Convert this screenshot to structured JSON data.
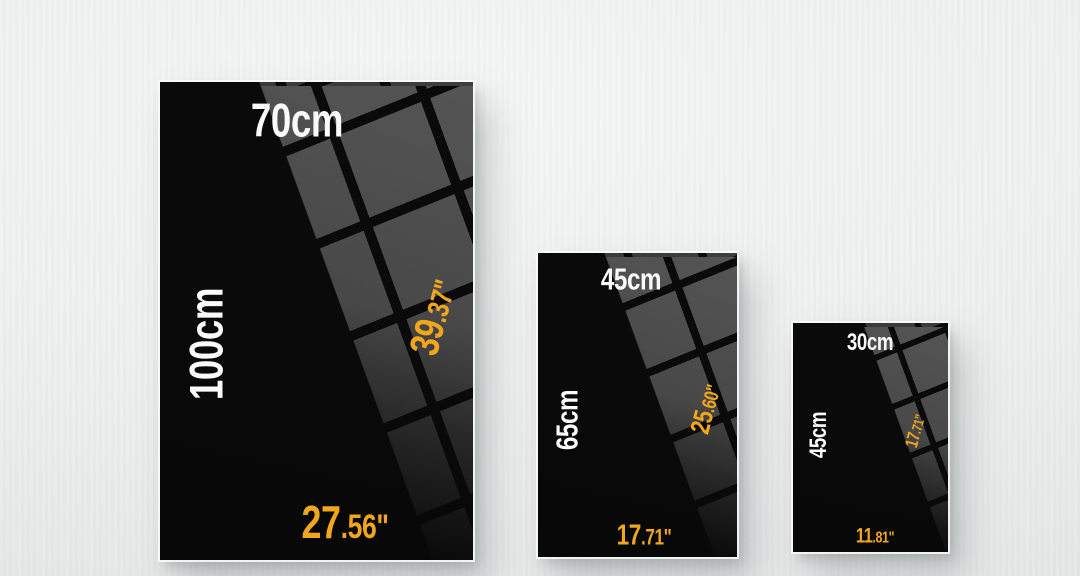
{
  "colors": {
    "accent_orange": "#F2A61D",
    "label_white": "#FAFAFA",
    "poster_black": "#0A0A0A",
    "pattern_gray": "#484848",
    "wall_light": "#F1F2F2"
  },
  "posters": [
    {
      "id": "large",
      "width_cm": "70cm",
      "height_cm": "100cm",
      "height_in_main": "39",
      "height_in_frac": ".37\"",
      "width_in_main": "27",
      "width_in_frac": ".56\""
    },
    {
      "id": "medium",
      "width_cm": "45cm",
      "height_cm": "65cm",
      "height_in_main": "25",
      "height_in_frac": ".60\"",
      "width_in_main": "17",
      "width_in_frac": ".71\""
    },
    {
      "id": "small",
      "width_cm": "30cm",
      "height_cm": "45cm",
      "height_in_main": "17",
      "height_in_frac": ".71\"",
      "width_in_main": "11",
      "width_in_frac": ".81\""
    }
  ]
}
